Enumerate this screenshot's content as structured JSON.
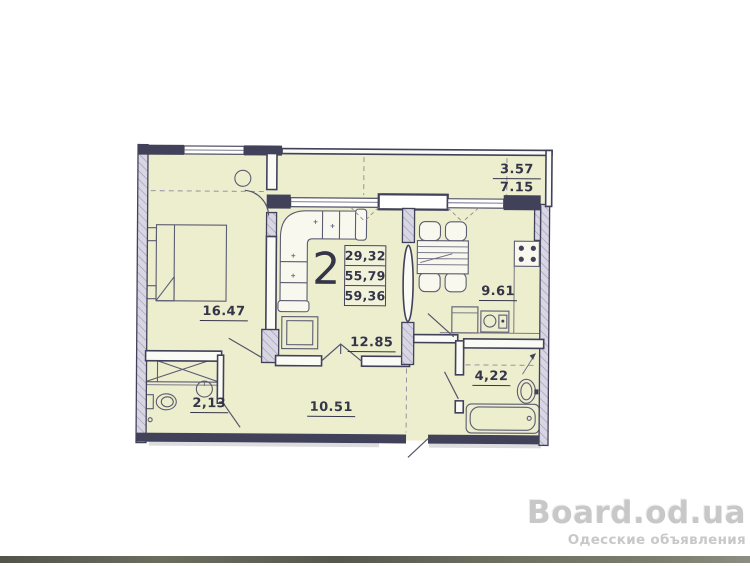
{
  "plan": {
    "unit_label": "2",
    "area_table": {
      "rows": [
        "29,32",
        "55,79",
        "59,36"
      ]
    },
    "rooms": {
      "bedroom": "16.47",
      "living": "12.85",
      "hall": "10.51",
      "wc": "2,13",
      "kitchen": "9.61",
      "bathroom": "4,22",
      "balcony_top": "3.57",
      "balcony_bottom": "7.15"
    },
    "colors": {
      "room_fill": "#edeecd",
      "wall": "#41415a",
      "hatch_fill": "#d9d6e4",
      "hatch_line": "#9d97b5",
      "label": "#35354a",
      "watermark": "#c8c8c8"
    }
  },
  "watermark": {
    "title": "Board.od.ua",
    "subtitle": "Одесские объявления"
  }
}
